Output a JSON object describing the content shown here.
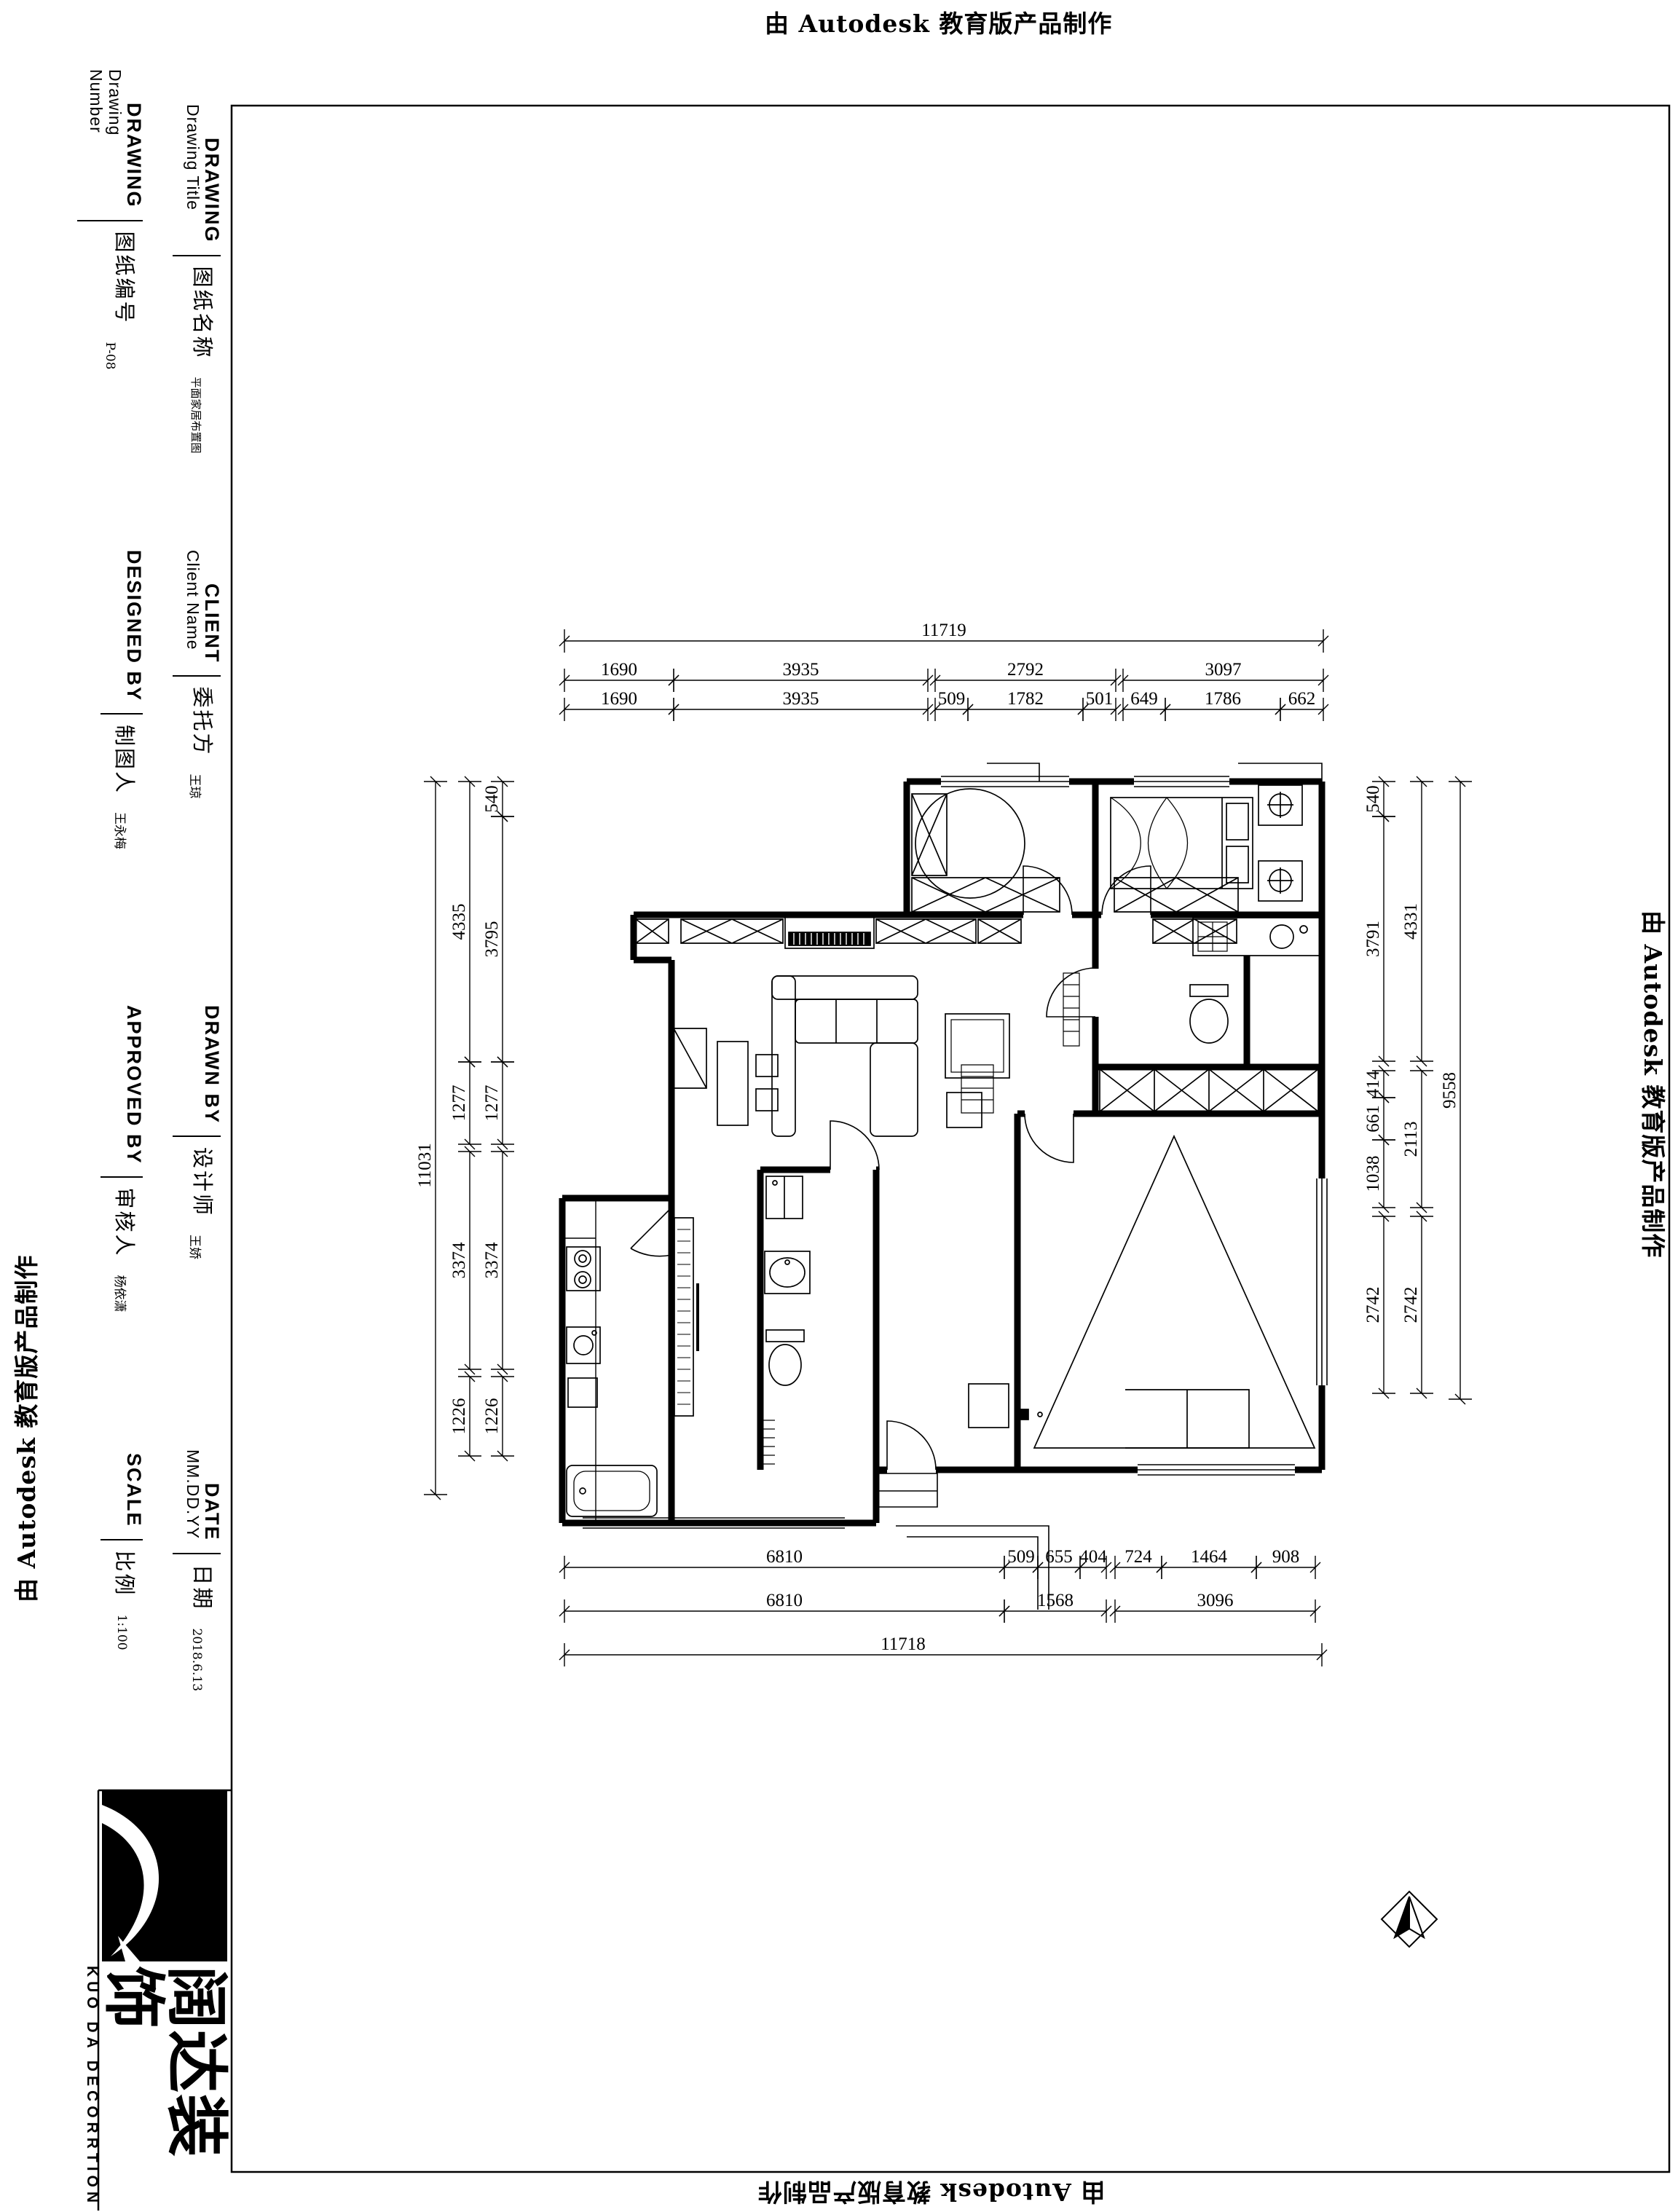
{
  "watermark": {
    "text": "由 Autodesk 教育版产品制作"
  },
  "title_block": {
    "blocks": [
      {
        "id": "drawing-number",
        "en_title": "DRAWING",
        "en_sub": "Drawing\nNumber",
        "cn": "图纸编号",
        "value": "P-08"
      },
      {
        "id": "drawing-title",
        "en_title": "DRAWING",
        "en_sub": "Drawing Title",
        "cn": "图纸名称",
        "value": "平面家居布置图"
      },
      {
        "id": "client",
        "en_title": "CLIENT",
        "en_sub": "Client Name",
        "cn": "委托方",
        "value": "王琼"
      },
      {
        "id": "designed-by",
        "en_title": "DESIGNED BY",
        "en_sub": "",
        "cn": "制图人",
        "value": "王永梅"
      },
      {
        "id": "drawn-by",
        "en_title": "DRAWN BY",
        "en_sub": "",
        "cn": "设计师",
        "value": "王娇"
      },
      {
        "id": "approved-by",
        "en_title": "APPROVED BY",
        "en_sub": "",
        "cn": "审核人",
        "value": "杨依潇"
      },
      {
        "id": "date",
        "en_title": "DATE",
        "en_sub": "MM.DD.YY",
        "cn": "日期",
        "value": "2018.6.13"
      },
      {
        "id": "scale",
        "en_title": "SCALE",
        "en_sub": "",
        "cn": "比例",
        "value": "1:100"
      }
    ]
  },
  "logo": {
    "cn": "阔达装饰",
    "en": "KUO DA DECORRTION"
  },
  "dimensions": {
    "top": {
      "overall": "11719",
      "row2": [
        "1690",
        "3935",
        "2792",
        "3097"
      ],
      "row3": [
        "1690",
        "3935",
        "509",
        "1782",
        "501",
        "649",
        "1786",
        "662"
      ]
    },
    "bottom": {
      "row1": [
        "6810",
        "509",
        "655",
        "404",
        "724",
        "1464",
        "908"
      ],
      "row2": [
        "6810",
        "1568",
        "3096"
      ],
      "overall": "11718"
    },
    "left": {
      "inner": [
        "540",
        "3795",
        "1277",
        "3374",
        "1226"
      ],
      "mid": [
        "4335",
        "1277",
        "3374",
        "1226"
      ],
      "overall": "11031"
    },
    "right": {
      "inner": [
        "540",
        "3791",
        "414",
        "661",
        "1038",
        "2742"
      ],
      "mid": [
        "4331",
        "2113",
        "2742"
      ],
      "overall": "9558"
    }
  }
}
